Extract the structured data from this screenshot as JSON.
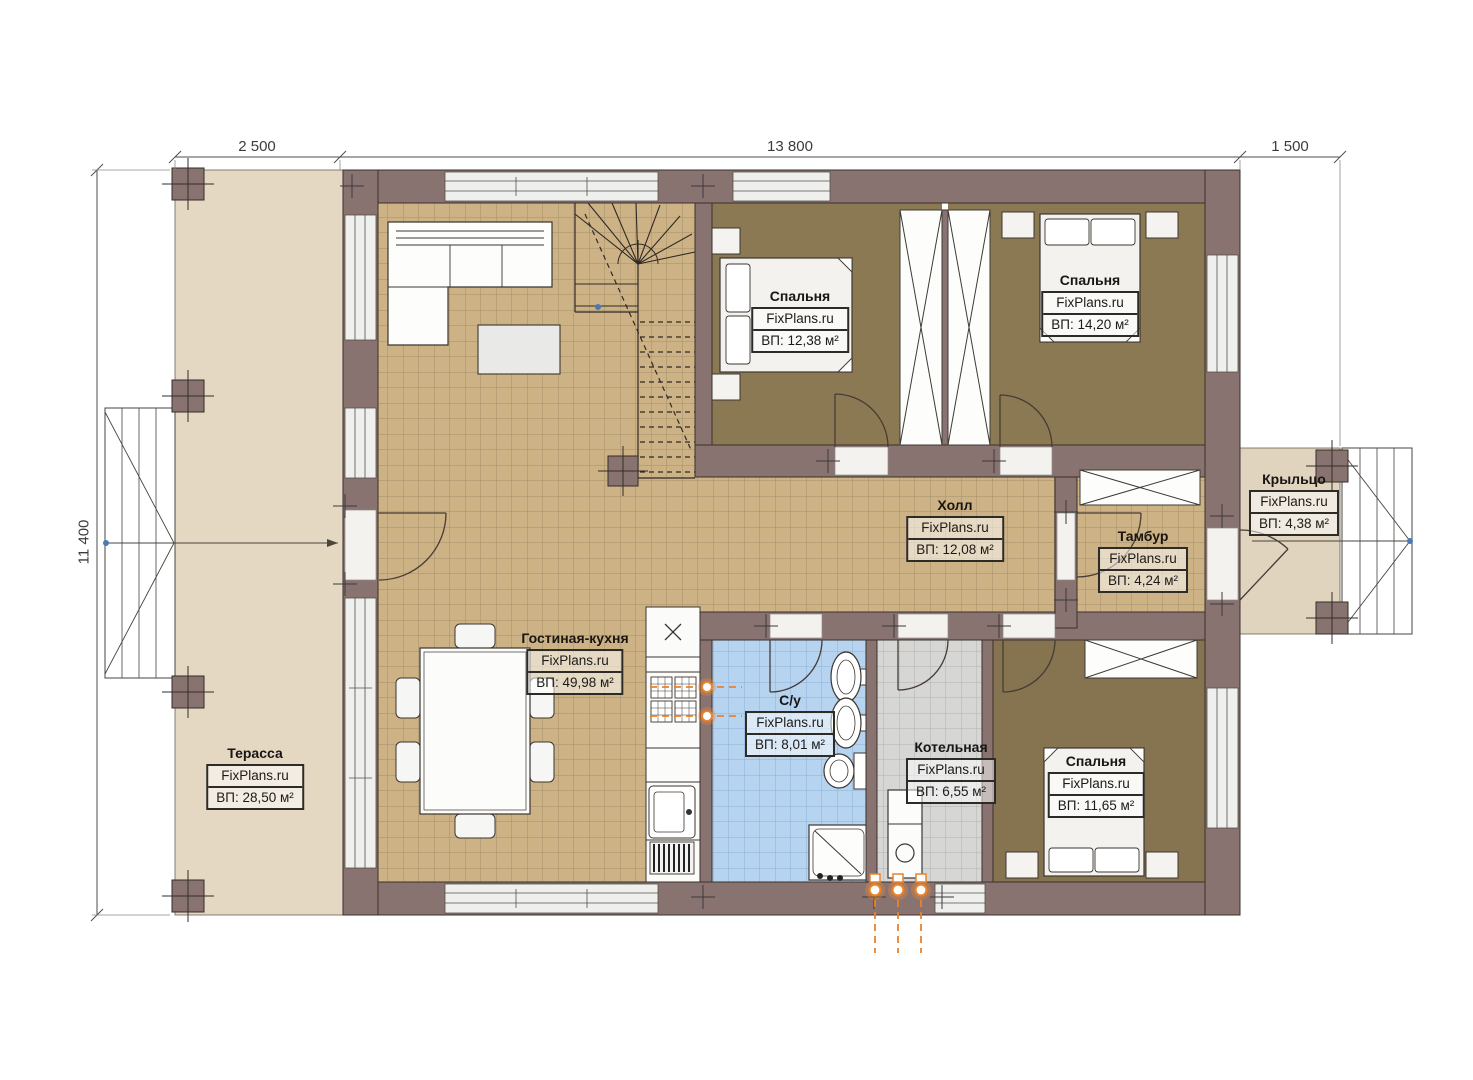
{
  "dimensions": {
    "terrace_width": "2 500",
    "house_width": "13 800",
    "porch_width": "1 500",
    "house_depth": "11 400"
  },
  "rooms": {
    "terrace": {
      "name": "Терасса",
      "brand": "FixPlans.ru",
      "area": "ВП: 28,50 м²"
    },
    "living_kitchen": {
      "name": "Гостиная-кухня",
      "brand": "FixPlans.ru",
      "area": "ВП: 49,98 м²"
    },
    "bedroom1": {
      "name": "Спальня",
      "brand": "FixPlans.ru",
      "area": "ВП: 12,38 м²"
    },
    "bedroom2": {
      "name": "Спальня",
      "brand": "FixPlans.ru",
      "area": "ВП: 14,20 м²"
    },
    "hall": {
      "name": "Холл",
      "brand": "FixPlans.ru",
      "area": "ВП: 12,08 м²"
    },
    "tambour": {
      "name": "Тамбур",
      "brand": "FixPlans.ru",
      "area": "ВП: 4,24 м²"
    },
    "porch": {
      "name": "Крыльцо",
      "brand": "FixPlans.ru",
      "area": "ВП: 4,38 м²"
    },
    "bathroom": {
      "name": "С/у",
      "brand": "FixPlans.ru",
      "area": "ВП: 8,01 м²"
    },
    "boiler": {
      "name": "Котельная",
      "brand": "FixPlans.ru",
      "area": "ВП: 6,55 м²"
    },
    "bedroom3": {
      "name": "Спальня",
      "brand": "FixPlans.ru",
      "area": "ВП: 11,65 м²"
    }
  },
  "colors": {
    "wall": "#897370",
    "floor_tile_tan": "#cdb285",
    "bedroom_carpet": "#8b7954",
    "bathroom_tile": "#b6d3f0",
    "boiler_tile": "#d6d6d5",
    "terrace_fill": "#e4d8c3",
    "porch_fill": "#e0d4be",
    "utility_orange": "#e8832d",
    "marker_blue": "#4a7ab5"
  }
}
